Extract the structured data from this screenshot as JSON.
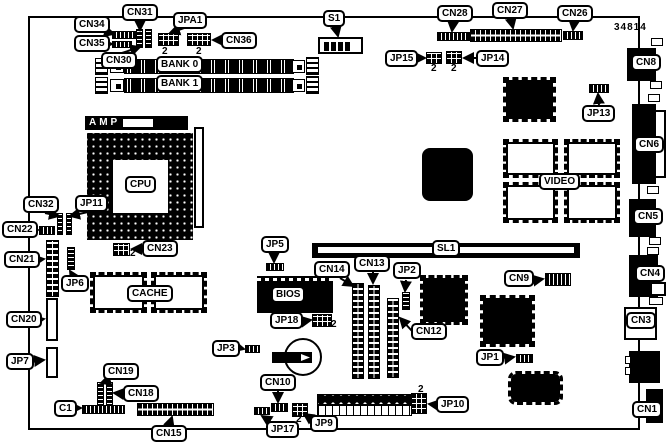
{
  "figure": {
    "part_number": "34814",
    "pin_label": "2",
    "labels": {
      "cn34": "CN34",
      "cn31": "CN31",
      "jpa1": "JPA1",
      "cn35": "CN35",
      "cn30": "CN30",
      "cn36": "CN36",
      "bank0": "BANK 0",
      "bank1": "BANK 1",
      "s1": "S1",
      "cn28": "CN28",
      "cn27": "CN27",
      "cn26": "CN26",
      "jp15": "JP15",
      "jp14": "JP14",
      "jp13": "JP13",
      "cn8": "CN8",
      "cn6": "CN6",
      "cn5": "CN5",
      "cn4": "CN4",
      "cn3": "CN3",
      "cn1": "CN1",
      "amp": "AMP",
      "cpu": "CPU",
      "cn32": "CN32",
      "jp11": "JP11",
      "cn22": "CN22",
      "cn21": "CN21",
      "jp6": "JP6",
      "cn20": "CN20",
      "jp7": "JP7",
      "cn23": "CN23",
      "cache": "CACHE",
      "bios": "BIOS",
      "jp5": "JP5",
      "jp18": "JP18",
      "cn14": "CN14",
      "cn13": "CN13",
      "jp2": "JP2",
      "sl1": "SL1",
      "cn9": "CN9",
      "video": "VIDEO",
      "cn12": "CN12",
      "jp3": "JP3",
      "jp1": "JP1",
      "cn10": "CN10",
      "jp17": "JP17",
      "jp9": "JP9",
      "jp10": "JP10",
      "cn15": "CN15",
      "c1": "C1",
      "cn19": "CN19",
      "cn18": "CN18"
    }
  }
}
